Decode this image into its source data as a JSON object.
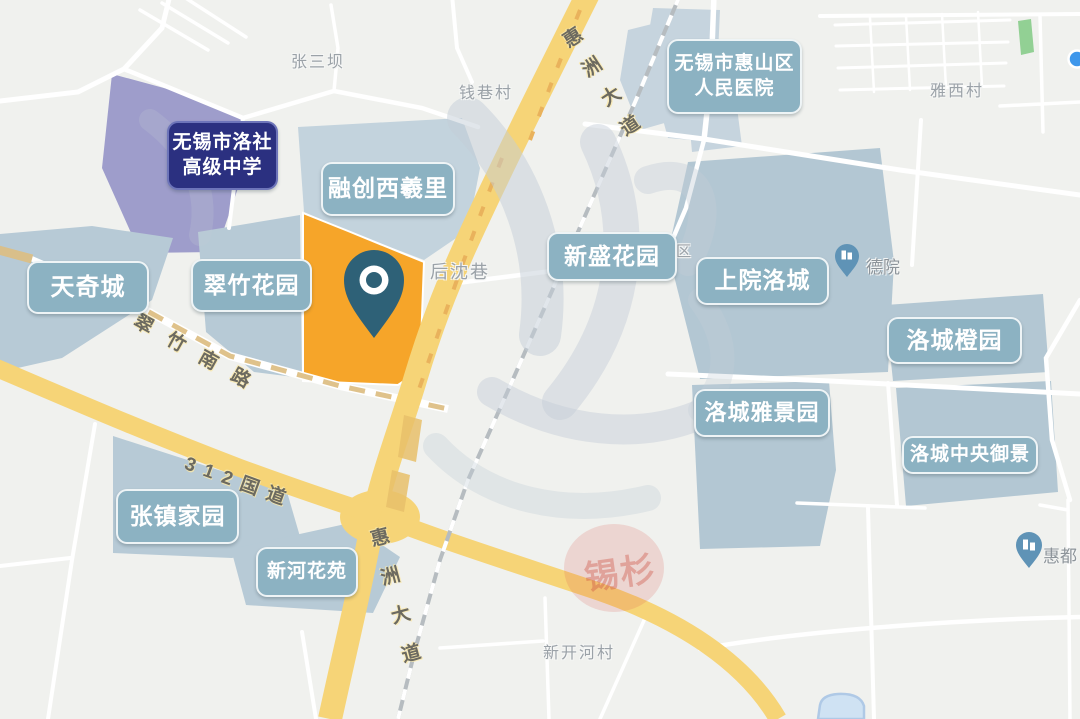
{
  "estates": {
    "tianqicheng": "天奇城",
    "cuizhuhuayuan": "翠竹花园",
    "rongchuangxixili": "融创西羲里",
    "xinshenghuayuan": "新盛花园",
    "shangyuanluocheng": "上院洛城",
    "luochengchengyuan": "洛城橙园",
    "luochengyajingyuan": "洛城雅景园",
    "luochengzhongyangyujing": "洛城中央御景",
    "zhangzhenjiayuan": "张镇家园",
    "xinhehuayuan": "新河花苑"
  },
  "landmarks": {
    "school_line1": "无锡市洛社",
    "school_line2": "高级中学",
    "hospital_line1": "无锡市惠山区",
    "hospital_line2": "人民医院"
  },
  "villages": {
    "zhangsanba": "张三坝",
    "qianxiangcun": "钱巷村",
    "yaxicun": "雅西村",
    "houshenxiang": "后沈巷",
    "xinkaihecun": "新开河村",
    "luocheng_a_qu": "洛城A区"
  },
  "roads": {
    "huizhou_avenue": "惠洲大道",
    "cuizhu_south_road": "翠竹南路",
    "g312": "312国道"
  },
  "pois": {
    "deyuan": "德院",
    "huidu": "惠都"
  },
  "watermark": {
    "stamp_text": "锡杉"
  },
  "colors": {
    "estate_label_bg": "#8CB2C2",
    "school_label_bg": "#2B3080",
    "highlight_parcel_orange": "#F6A529",
    "marker_pin": "#2E6177",
    "road_yellow": "#F6D477",
    "block_blue": "#B7CAD6",
    "school_block_purple": "#9E9DCB",
    "park_green": "#92D094",
    "station_dot_blue": "#3E97EB"
  }
}
